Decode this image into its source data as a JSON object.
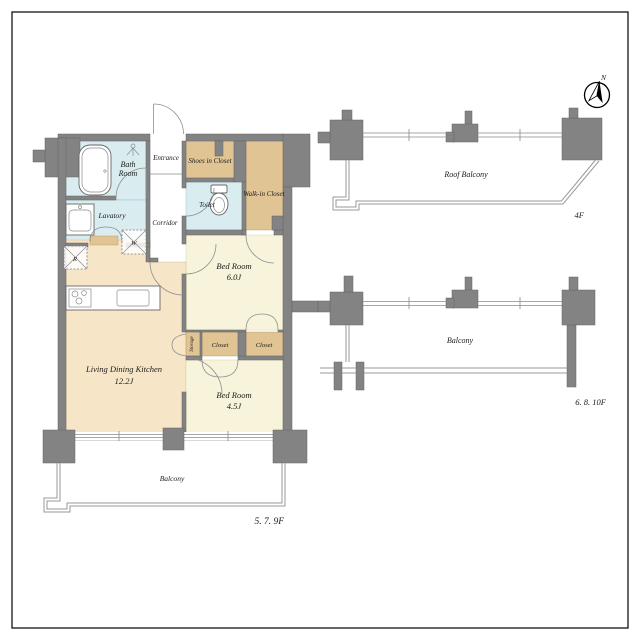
{
  "colors": {
    "wall": "#838383",
    "outline": "#646464",
    "room-blue": "#d9edf0",
    "room-tan": "#e0c493",
    "room-cream": "#f6e5c6",
    "room-yellow": "#f7f4db"
  },
  "compass": {
    "north_label": "N"
  },
  "main": {
    "floor_label": "5. 7. 9F",
    "rooms": {
      "bath": {
        "line1": "Bath",
        "line2": "Room"
      },
      "entrance": {
        "label": "Entrance"
      },
      "shoes_closet": {
        "label": "Shoes in Closet"
      },
      "toilet": {
        "label": "Toilet"
      },
      "walkin_closet": {
        "label": "Walk-in Closet"
      },
      "lavatory": {
        "label": "Lavatory"
      },
      "corridor": {
        "label": "Corridor"
      },
      "refrigerator": {
        "label": "R"
      },
      "washer": {
        "label": "W"
      },
      "bedroom1": {
        "label": "Bed Room",
        "size": "6.0J"
      },
      "ldk": {
        "label": "Living Dining Kitchen",
        "size": "12.2J"
      },
      "storage": {
        "label": "Storage"
      },
      "closet1": {
        "label": "Closet"
      },
      "closet2": {
        "label": "Closet"
      },
      "bedroom2": {
        "label": "Bed Room",
        "size": "4.5J"
      },
      "balcony": {
        "label": "Balcony"
      }
    }
  },
  "plan_4f": {
    "area_label": "Roof Balcony",
    "floor_label": "4F"
  },
  "plan_6_8_10f": {
    "area_label": "Balcony",
    "floor_label": "6. 8. 10F"
  }
}
